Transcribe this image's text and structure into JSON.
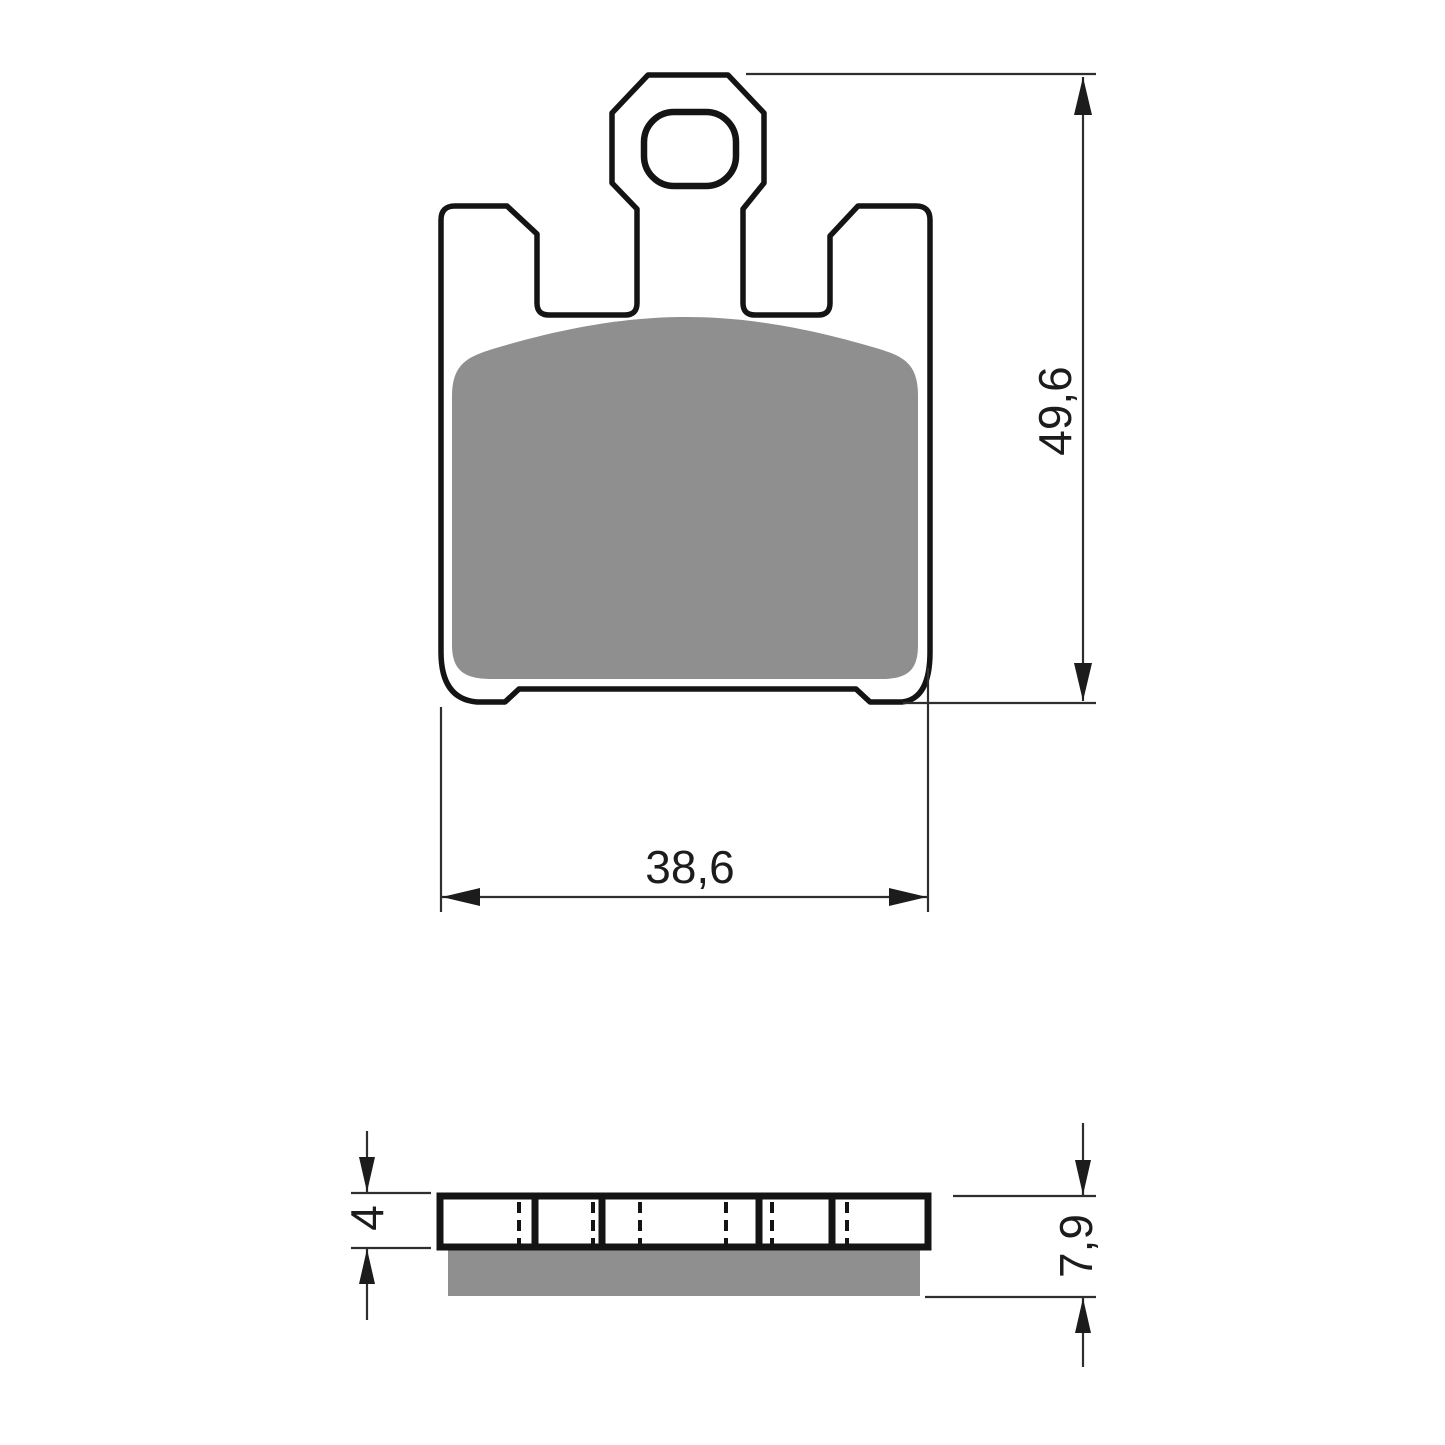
{
  "drawing": {
    "subject": "brake-pad-technical-drawing",
    "front_view": {
      "height_dim_label": "49,6",
      "width_dim_label": "38,6"
    },
    "side_view": {
      "backplate_thickness_dim_label": "4",
      "total_thickness_dim_label": "7,9"
    }
  },
  "colors": {
    "background": "#ffffff",
    "outline": "#141414",
    "dimension_line": "#2e2e2e",
    "friction_material": "#8f8f8f"
  }
}
